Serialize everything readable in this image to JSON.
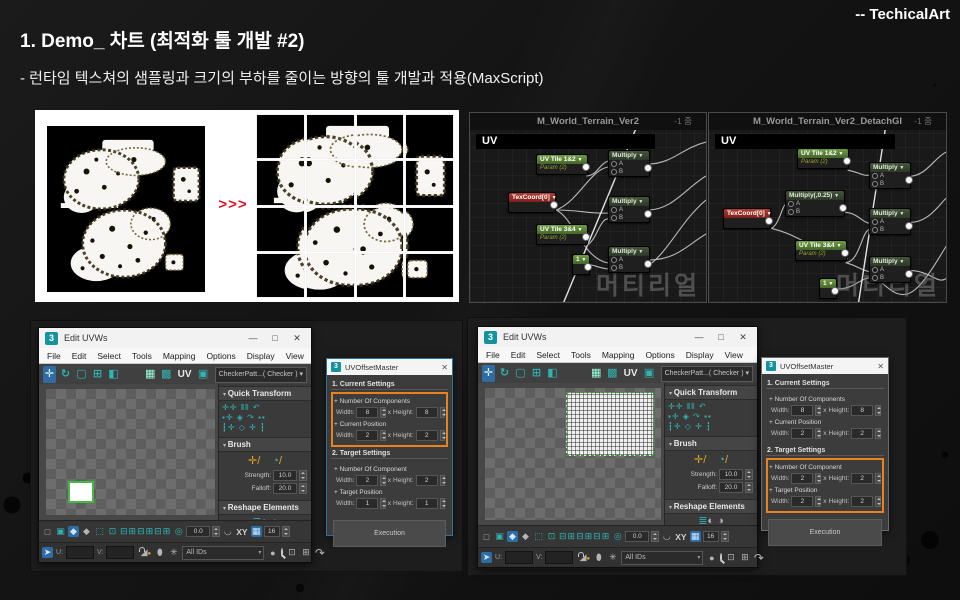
{
  "slide": {
    "credit": "-- TechicalArt",
    "title": "1. Demo_ 차트 (최적화 툴 개발 #2)",
    "subtitle": "- 런타임 텍스쳐의 샘플링과 크기의 부하를 줄이는 방향의 툴 개발과 적용(MaxScript)",
    "colors": {
      "accent_red": "#e11423",
      "accent_orange": "#e8821e",
      "max_teal": "#2fb3b3"
    }
  },
  "texture_panel": {
    "arrow_label": ">>>"
  },
  "material_panels": [
    {
      "title": "M_World_Terrain_Ver2",
      "zoom_label": "-1 줌",
      "section_label": "UV",
      "watermark": "머티리얼",
      "nodes": [
        {
          "label": "UV Tile 1&2",
          "sub": "Param (2)",
          "type": "param",
          "x": 66,
          "y": 24,
          "w": 50
        },
        {
          "label": "TexCoord[0]",
          "type": "coord",
          "x": 38,
          "y": 62,
          "w": 46
        },
        {
          "label": "UV Tile 3&4",
          "sub": "Param (2)",
          "type": "param",
          "x": 66,
          "y": 94,
          "w": 50
        },
        {
          "label": "1",
          "type": "const",
          "x": 102,
          "y": 124,
          "w": 16
        },
        {
          "label": "Multiply",
          "type": "op",
          "inputs": [
            "A",
            "B"
          ],
          "x": 138,
          "y": 20,
          "w": 40
        },
        {
          "label": "Multiply",
          "type": "op",
          "inputs": [
            "A",
            "B"
          ],
          "x": 138,
          "y": 66,
          "w": 40
        },
        {
          "label": "Multiply",
          "type": "op",
          "inputs": [
            "A",
            "B"
          ],
          "x": 138,
          "y": 116,
          "w": 40
        }
      ]
    },
    {
      "title": "M_World_Terrain_Ver2_DetachGI",
      "zoom_label": "-1 줌",
      "section_label": "UV",
      "watermark": "머티리얼",
      "nodes": [
        {
          "label": "UV Tile 1&2",
          "sub": "Param (2)",
          "type": "param",
          "x": 88,
          "y": 18,
          "w": 50
        },
        {
          "label": "Multiply(,0.25)",
          "type": "op",
          "inputs": [
            "A",
            "B"
          ],
          "x": 76,
          "y": 60,
          "w": 58
        },
        {
          "label": "TexCoord[0]",
          "type": "coord",
          "x": 14,
          "y": 78,
          "w": 46
        },
        {
          "label": "UV Tile 3&4",
          "sub": "Param (2)",
          "type": "param",
          "x": 86,
          "y": 110,
          "w": 50
        },
        {
          "label": "1",
          "type": "const",
          "x": 110,
          "y": 148,
          "w": 16
        },
        {
          "label": "Multiply",
          "type": "op",
          "inputs": [
            "A",
            "B"
          ],
          "x": 160,
          "y": 32,
          "w": 40
        },
        {
          "label": "Multiply",
          "type": "op",
          "inputs": [
            "A",
            "B"
          ],
          "x": 160,
          "y": 78,
          "w": 40
        },
        {
          "label": "Multiply",
          "type": "op",
          "inputs": [
            "A",
            "B"
          ],
          "x": 160,
          "y": 126,
          "w": 40
        }
      ]
    }
  ],
  "uv_windows": [
    {
      "window_title": "Edit UVWs",
      "menu": [
        "File",
        "Edit",
        "Select",
        "Tools",
        "Mapping",
        "Options",
        "Display",
        "View"
      ],
      "toolbar_uv_label": "UV",
      "map_dropdown": "CheckerPatt...( Checker )",
      "rollouts": {
        "quick_transform": "Quick Transform",
        "brush": "Brush",
        "strength_label": "Strength:",
        "strength_value": "10.0",
        "falloff_label": "Falloff:",
        "falloff_value": "20.0",
        "reshape": "Reshape Elements",
        "stitch": "Stitch"
      },
      "bottom": {
        "angle_value": "0.0",
        "xy_label": "XY",
        "grid_value": "16",
        "u_label": "U:",
        "v_label": "V:",
        "ids_dropdown": "All IDs"
      },
      "canvas_selection": "square"
    },
    {
      "window_title": "Edit UVWs",
      "menu": [
        "File",
        "Edit",
        "Select",
        "Tools",
        "Mapping",
        "Options",
        "Display",
        "View"
      ],
      "toolbar_uv_label": "UV",
      "map_dropdown": "CheckerPatt...( Checker )",
      "rollouts": {
        "quick_transform": "Quick Transform",
        "brush": "Brush",
        "strength_label": "Strength:",
        "strength_value": "10.0",
        "falloff_label": "Falloff:",
        "falloff_value": "20.0",
        "reshape": "Reshape Elements",
        "stitch": "Stitch"
      },
      "bottom": {
        "angle_value": "0.0",
        "xy_label": "XY",
        "grid_value": "16",
        "u_label": "U:",
        "v_label": "V:",
        "ids_dropdown": "All IDs"
      },
      "canvas_selection": "mesh"
    }
  ],
  "dialogs": [
    {
      "title": "UVOffsetMaster",
      "sections": [
        {
          "heading": "1. Current Settings",
          "highlighted": true,
          "groups": [
            {
              "label": "+ Number Of Components",
              "width_label": "Width:",
              "width": "8",
              "x_label": "x",
              "height_label": "Height:",
              "height": "8"
            },
            {
              "label": "+ Current Position",
              "width_label": "Width:",
              "width": "2",
              "x_label": "x",
              "height_label": "Height:",
              "height": "2"
            }
          ]
        },
        {
          "heading": "2. Target Settings",
          "highlighted": false,
          "groups": [
            {
              "label": "+ Number Of Component",
              "width_label": "Width:",
              "width": "2",
              "x_label": "x",
              "height_label": "Height:",
              "height": "2"
            },
            {
              "label": "+ Target Position",
              "width_label": "Width:",
              "width": "1",
              "x_label": "x",
              "height_label": "Height:",
              "height": "1"
            }
          ]
        }
      ],
      "button": "Execution"
    },
    {
      "title": "UVOffsetMaster",
      "sections": [
        {
          "heading": "1. Current Settings",
          "highlighted": false,
          "groups": [
            {
              "label": "+ Number Of Components",
              "width_label": "Width:",
              "width": "8",
              "x_label": "x",
              "height_label": "Height:",
              "height": "8"
            },
            {
              "label": "+ Current Position",
              "width_label": "Width:",
              "width": "2",
              "x_label": "x",
              "height_label": "Height:",
              "height": "2"
            }
          ]
        },
        {
          "heading": "2. Target Settings",
          "highlighted": true,
          "groups": [
            {
              "label": "+ Number Of Component",
              "width_label": "Width:",
              "width": "2",
              "x_label": "x",
              "height_label": "Height:",
              "height": "2"
            },
            {
              "label": "+ Target Position",
              "width_label": "Width:",
              "width": "2",
              "x_label": "x",
              "height_label": "Height:",
              "height": "2"
            }
          ]
        }
      ],
      "button": "Execution"
    }
  ]
}
